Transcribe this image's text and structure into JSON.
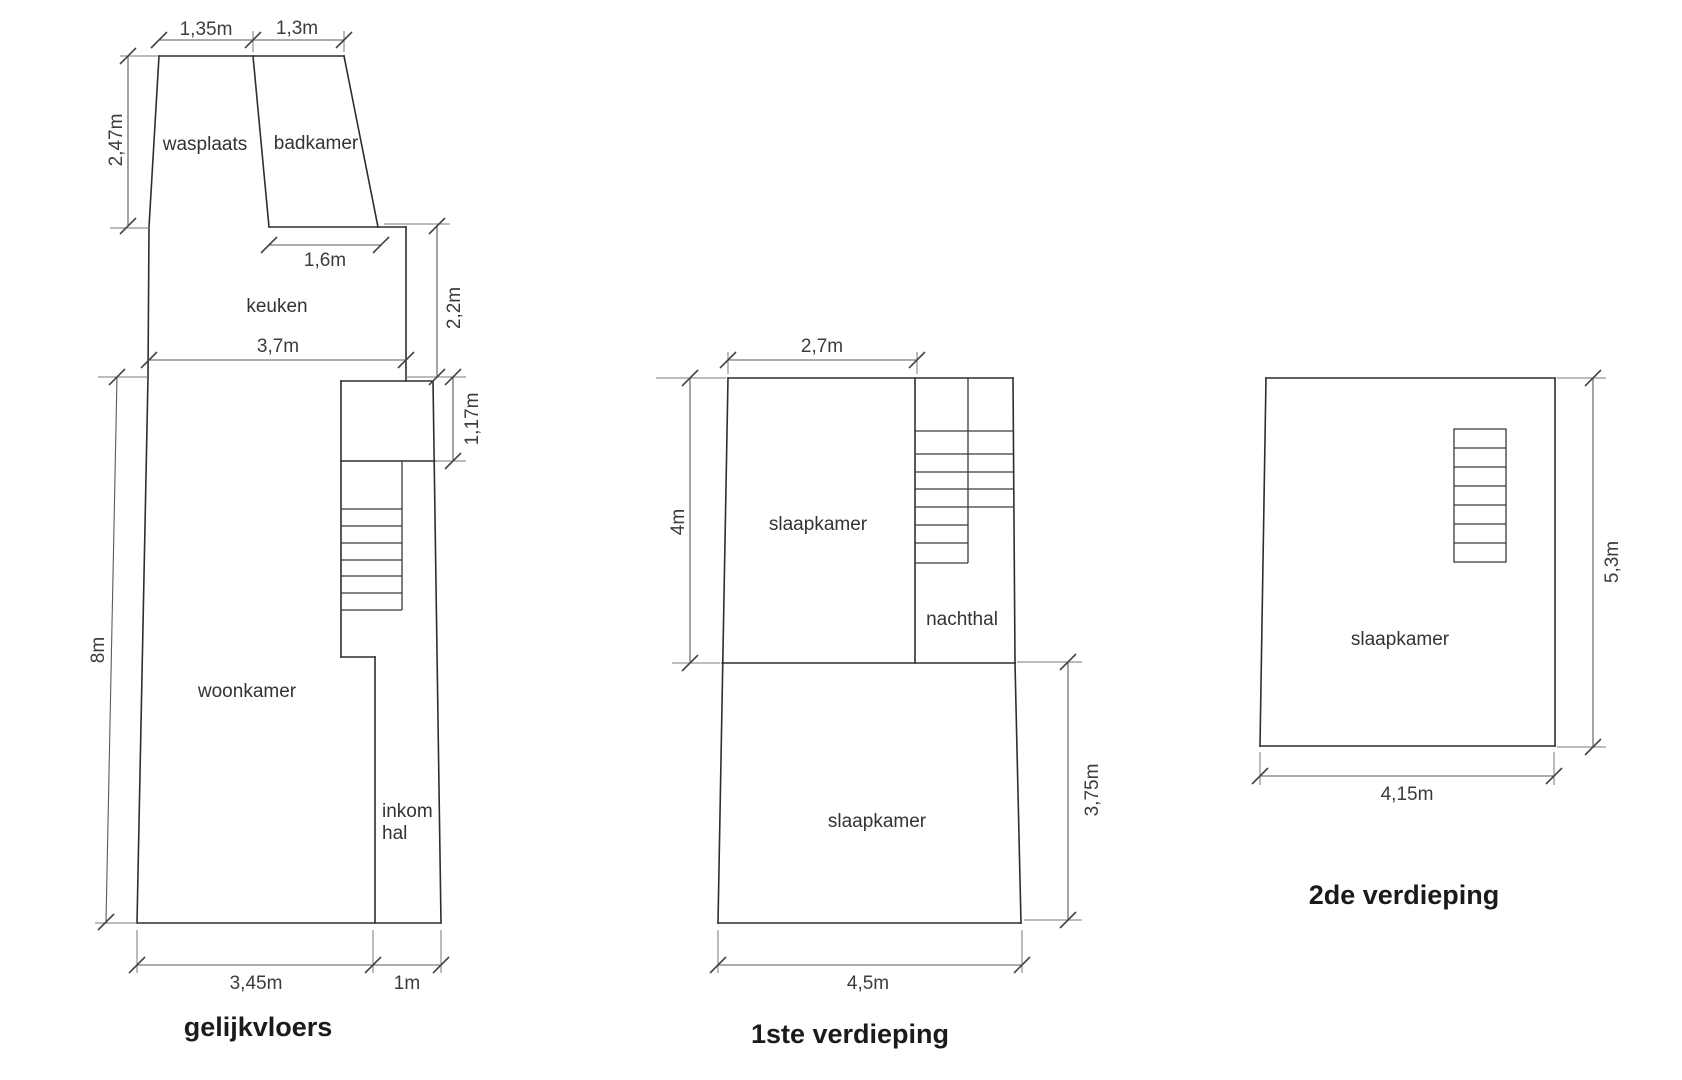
{
  "page": {
    "background": "#ffffff",
    "wall_color": "#2e2e2e",
    "dimension_line_color": "#5a5a5a",
    "text_color": "#333333"
  },
  "ground_floor": {
    "title": "gelijkvloers",
    "rooms": {
      "wasplaats": "wasplaats",
      "badkamer": "badkamer",
      "keuken": "keuken",
      "woonkamer": "woonkamer",
      "inkom_hal_line1": "inkom",
      "inkom_hal_line2": "hal"
    },
    "dims": {
      "wasplaats_width": "1,35m",
      "badkamer_width": "1,3m",
      "wasplaats_height": "2,47m",
      "badkamer_bottom_width": "1,6m",
      "keuken_right_height": "2,2m",
      "keuken_width": "3,7m",
      "landing_height": "1,17m",
      "woonkamer_height": "8m",
      "woonkamer_width": "3,45m",
      "inkom_hal_width": "1m"
    }
  },
  "first_floor": {
    "title": "1ste verdieping",
    "rooms": {
      "slaapkamer_top": "slaapkamer",
      "nachthal": "nachthal",
      "slaapkamer_bottom": "slaapkamer"
    },
    "dims": {
      "slaapkamer_top_width": "2,7m",
      "slaapkamer_top_height": "4m",
      "slaapkamer_bottom_height": "3,75m",
      "slaapkamer_bottom_width": "4,5m"
    }
  },
  "second_floor": {
    "title": "2de verdieping",
    "rooms": {
      "slaapkamer": "slaapkamer"
    },
    "dims": {
      "height": "5,3m",
      "width": "4,15m"
    }
  }
}
